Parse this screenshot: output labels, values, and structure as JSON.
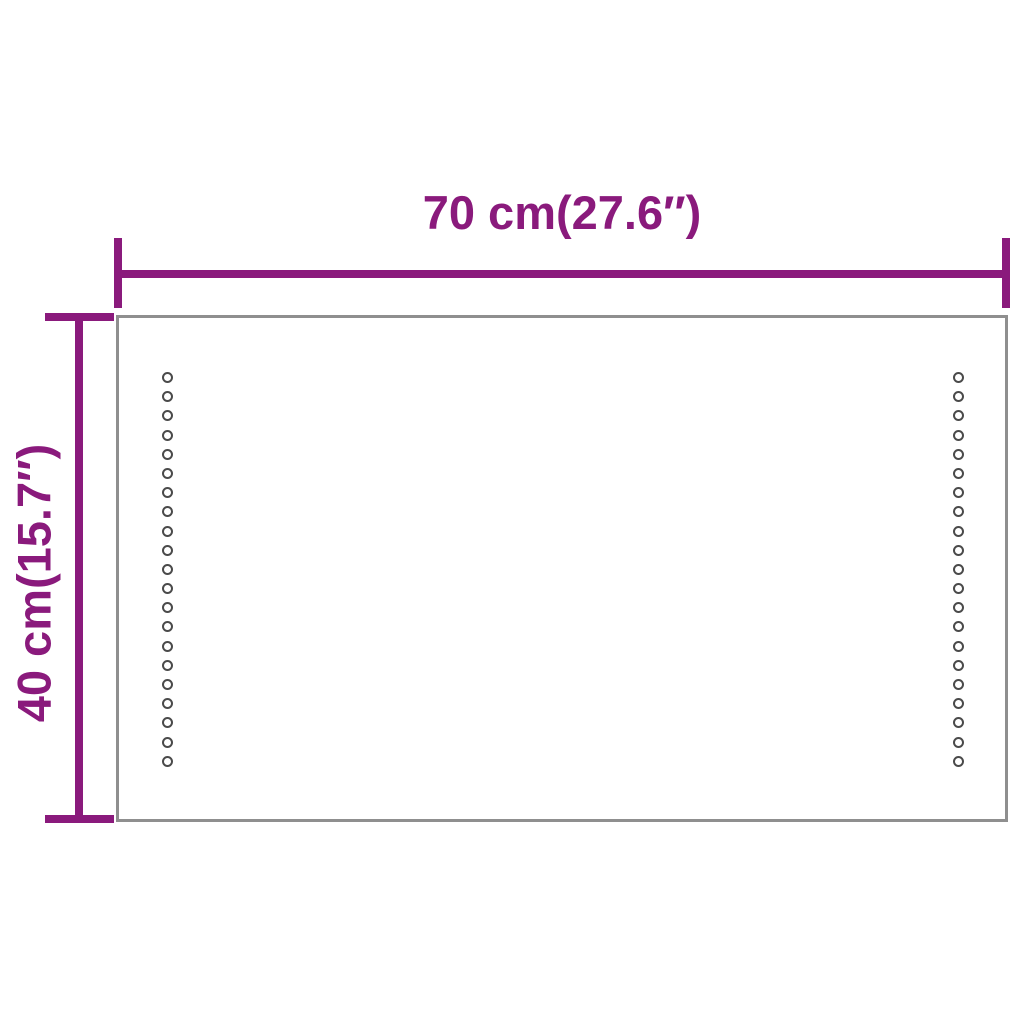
{
  "image": {
    "description": "Product dimension diagram of a rectangular LED mirror with two vertical rows of LED dots",
    "background_color": "#ffffff"
  },
  "diagram": {
    "accent_color": "#8a1a7c",
    "frame_color": "#8f8f8f",
    "led_dot_color": "#4a4a4a",
    "width_dimension": {
      "label": "70 cm(27.6″)",
      "value_cm": 70,
      "value_inch": 27.6
    },
    "height_dimension": {
      "label": "40 cm(15.7″)",
      "value_cm": 40,
      "value_inch": 15.7
    },
    "led_columns": {
      "count": 2,
      "dots_per_column": 21
    }
  }
}
